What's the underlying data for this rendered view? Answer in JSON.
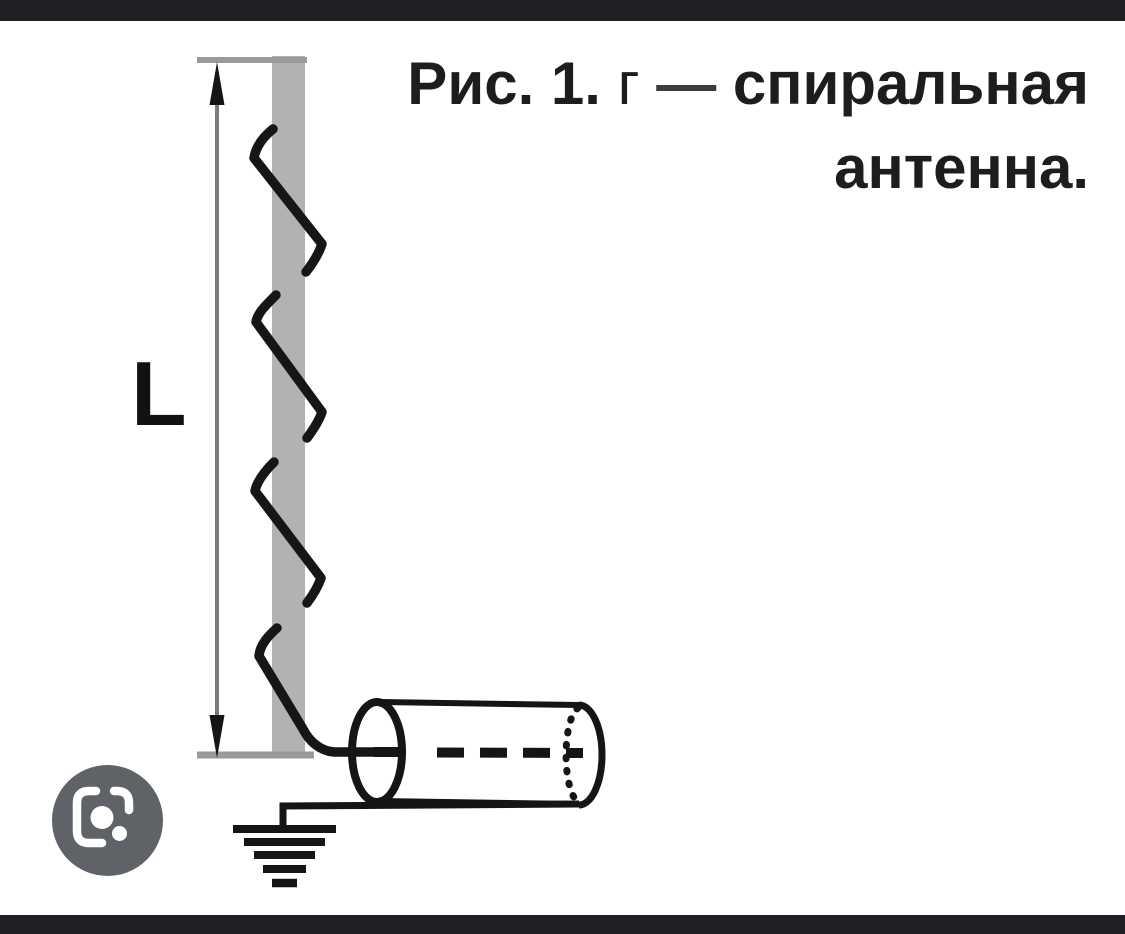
{
  "viewer": {
    "width": 1125,
    "height": 934,
    "letterbox_color": "#1f2125",
    "background": "#ffffff"
  },
  "caption": {
    "line1_prefix": "Рис. 1.",
    "line1_item": "г",
    "line1_dash": "—",
    "line1_term": "спиральная",
    "line2": "антенна.",
    "full_text": "Рис. 1. г — спиральная антенна."
  },
  "figure": {
    "dimension_label": "L",
    "description_elements": {
      "rod": "gray-dielectric-rod",
      "winding": "helical-wire-4-turns",
      "feed": "coaxial-cable-cylinder",
      "ground": "earth-ground-symbol-5-bars"
    },
    "colors": {
      "rod_gray": "#b2b2b2",
      "guide_line_gray": "#9a9a9a",
      "dimension_line_gray": "#7a7a7a",
      "ink_black": "#161616"
    }
  },
  "lens_button": {
    "icon": "google-lens-icon",
    "background": "#5f6368",
    "icon_color": "#ffffff"
  }
}
